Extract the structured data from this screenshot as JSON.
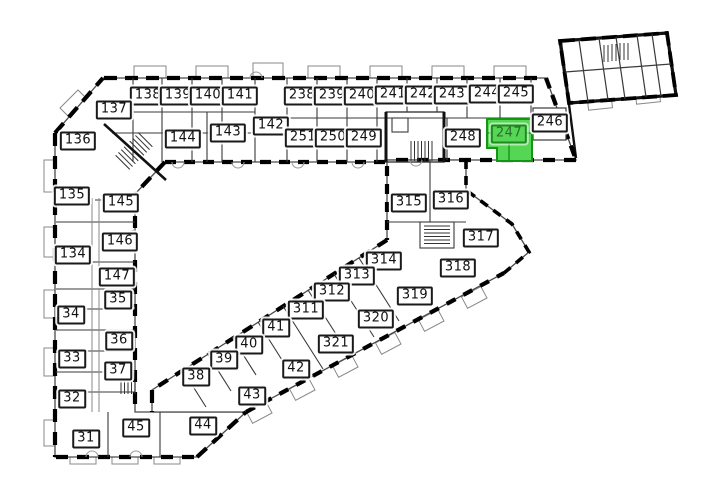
{
  "plan": {
    "kind": "building-floor-plan",
    "background": "#ffffff",
    "wall_color": "#000000",
    "selected_unit": "247"
  },
  "label_style": {
    "bg": "#ffffff",
    "border": "#1a1a1a",
    "text": "#111111"
  },
  "highlight": {
    "unit": "247",
    "room_fill": "#55d755",
    "room_stroke": "#169416",
    "label_bg": "#55d755",
    "label_border": "#1f8a1f",
    "label_text": "#2f6b2f"
  },
  "units": [
    {
      "id": "138",
      "x": 148,
      "y": 96
    },
    {
      "id": "139",
      "x": 178,
      "y": 96
    },
    {
      "id": "140",
      "x": 208,
      "y": 96
    },
    {
      "id": "141",
      "x": 240,
      "y": 96
    },
    {
      "id": "238",
      "x": 302,
      "y": 96
    },
    {
      "id": "239",
      "x": 332,
      "y": 96
    },
    {
      "id": "240",
      "x": 362,
      "y": 96
    },
    {
      "id": "241",
      "x": 393,
      "y": 95
    },
    {
      "id": "242",
      "x": 423,
      "y": 95
    },
    {
      "id": "243",
      "x": 452,
      "y": 95
    },
    {
      "id": "244",
      "x": 487,
      "y": 94
    },
    {
      "id": "245",
      "x": 516,
      "y": 94
    },
    {
      "id": "137",
      "x": 114,
      "y": 110
    },
    {
      "id": "136",
      "x": 78,
      "y": 141
    },
    {
      "id": "142",
      "x": 271,
      "y": 126
    },
    {
      "id": "143",
      "x": 228,
      "y": 133
    },
    {
      "id": "144",
      "x": 183,
      "y": 139
    },
    {
      "id": "251",
      "x": 303,
      "y": 138
    },
    {
      "id": "250",
      "x": 333,
      "y": 138
    },
    {
      "id": "249",
      "x": 364,
      "y": 138
    },
    {
      "id": "248",
      "x": 463,
      "y": 138
    },
    {
      "id": "247",
      "x": 509,
      "y": 134,
      "highlighted": true
    },
    {
      "id": "246",
      "x": 550,
      "y": 123
    },
    {
      "id": "135",
      "x": 72,
      "y": 196
    },
    {
      "id": "145",
      "x": 121,
      "y": 203
    },
    {
      "id": "146",
      "x": 120,
      "y": 242
    },
    {
      "id": "134",
      "x": 73,
      "y": 255
    },
    {
      "id": "147",
      "x": 117,
      "y": 277
    },
    {
      "id": "35",
      "x": 118,
      "y": 300
    },
    {
      "id": "34",
      "x": 71,
      "y": 315
    },
    {
      "id": "36",
      "x": 119,
      "y": 341
    },
    {
      "id": "33",
      "x": 72,
      "y": 359
    },
    {
      "id": "37",
      "x": 118,
      "y": 371
    },
    {
      "id": "32",
      "x": 72,
      "y": 399
    },
    {
      "id": "45",
      "x": 136,
      "y": 428
    },
    {
      "id": "31",
      "x": 86,
      "y": 439
    },
    {
      "id": "315",
      "x": 409,
      "y": 203
    },
    {
      "id": "316",
      "x": 451,
      "y": 200
    },
    {
      "id": "317",
      "x": 481,
      "y": 238
    },
    {
      "id": "318",
      "x": 458,
      "y": 268
    },
    {
      "id": "319",
      "x": 415,
      "y": 296
    },
    {
      "id": "314",
      "x": 384,
      "y": 261
    },
    {
      "id": "313",
      "x": 357,
      "y": 276
    },
    {
      "id": "312",
      "x": 332,
      "y": 292
    },
    {
      "id": "311",
      "x": 306,
      "y": 310
    },
    {
      "id": "320",
      "x": 376,
      "y": 319
    },
    {
      "id": "41",
      "x": 276,
      "y": 328
    },
    {
      "id": "321",
      "x": 336,
      "y": 344
    },
    {
      "id": "40",
      "x": 249,
      "y": 345
    },
    {
      "id": "39",
      "x": 224,
      "y": 360
    },
    {
      "id": "42",
      "x": 296,
      "y": 369
    },
    {
      "id": "38",
      "x": 196,
      "y": 377
    },
    {
      "id": "43",
      "x": 252,
      "y": 396
    },
    {
      "id": "44",
      "x": 203,
      "y": 426
    }
  ]
}
